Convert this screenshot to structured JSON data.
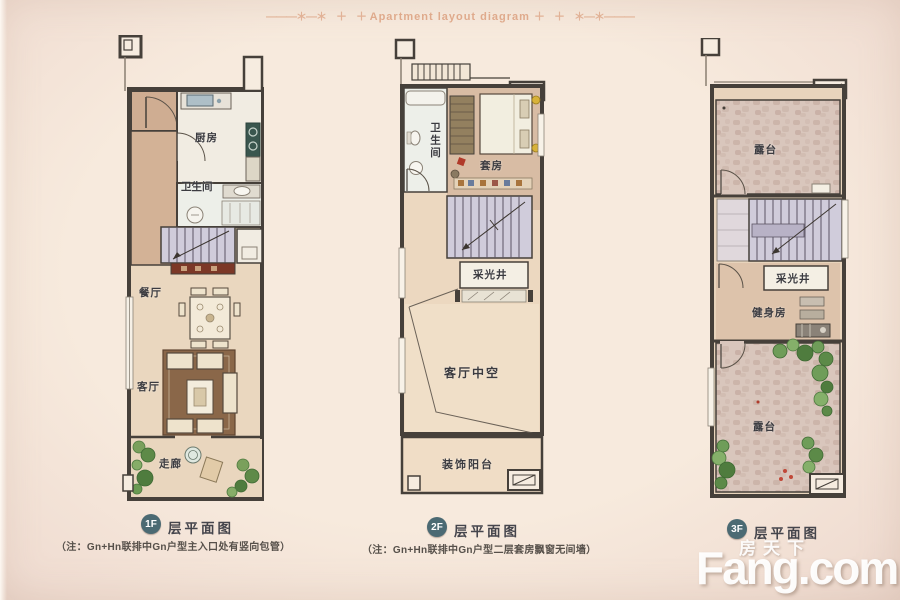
{
  "header": {
    "decor_left": "———＊—＊　＋　＋",
    "title": "Apartment layout diagram",
    "decor_right": "＋　＋　＊—＊———"
  },
  "plans": [
    {
      "badge": "1F",
      "caption": "层平面图",
      "note": "（注：Gn+Hn联排中Gn户型主入口处有竖向包管）",
      "rooms": {
        "kitchen": "厨房",
        "bathroom": "卫生间",
        "dining": "餐厅",
        "living": "客厅",
        "corridor": "走廊"
      }
    },
    {
      "badge": "2F",
      "caption": "层平面图",
      "note": "（注：Gn+Hn联排中Gn户型二层套房飘窗无间墙）",
      "rooms": {
        "bathroom": "卫生间",
        "suite": "套房",
        "lightwell": "采光井",
        "void": "客厅中空",
        "balcony": "装饰阳台"
      }
    },
    {
      "badge": "3F",
      "caption": "层平面图",
      "note": "",
      "rooms": {
        "terrace_top": "露台",
        "lightwell": "采光井",
        "gym": "健身房",
        "terrace_bottom": "露台"
      }
    }
  ],
  "watermark": {
    "cn": "房天下",
    "en": "Fang.com"
  },
  "colors": {
    "background": "#f5e8db",
    "wall": "#46403a",
    "floor_tan": "#e8d5bd",
    "floor_dark_tan": "#cfad92",
    "room_white": "#f1ece2",
    "stairs": "#d0ccdb",
    "stone": "#d9c6bc",
    "plant_green": "#6f9d59",
    "sideboard_red": "#7c3827",
    "stove_teal": "#3a564e",
    "sink_blue": "#aebfc7",
    "badge_teal": "#4b6a73",
    "header_text": "#dfaa8c",
    "watermark_white": "#ffffff"
  }
}
